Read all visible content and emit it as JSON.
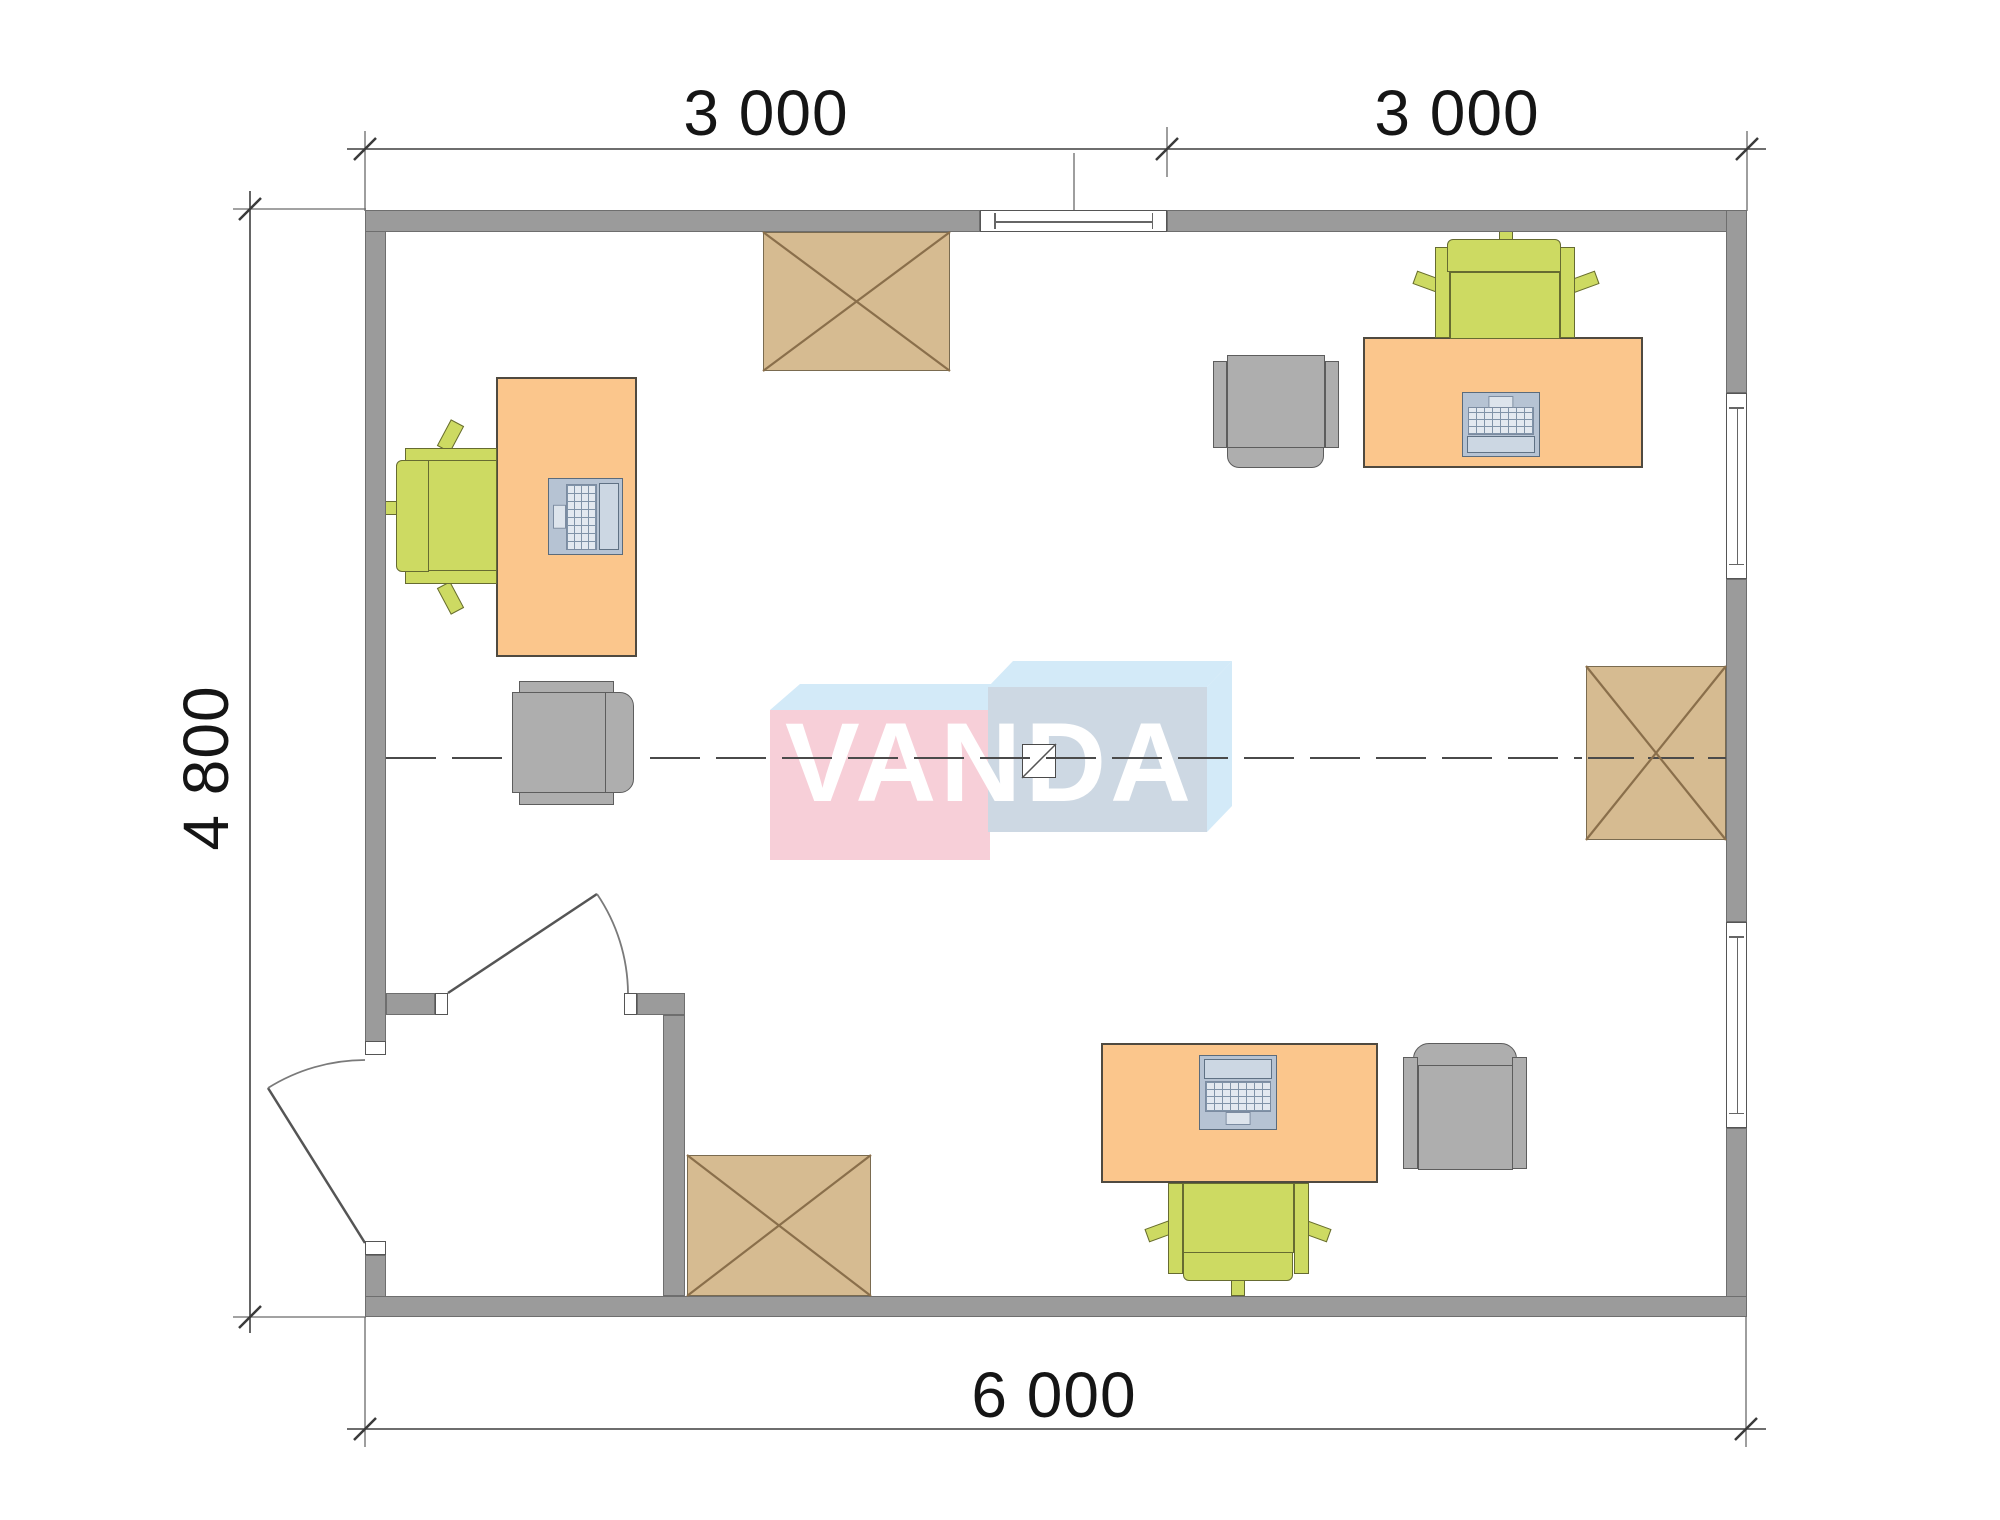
{
  "dimension_labels": {
    "top_left_span": "3 000",
    "top_right_span": "3 000",
    "left_span": "4 800",
    "bottom_span": "6 000"
  },
  "watermark": {
    "brand": "VANDA"
  },
  "plan": {
    "units": "mm",
    "room_width": "6 000",
    "room_depth": "4 800",
    "module_spans": [
      "3 000",
      "3 000"
    ]
  },
  "symbols": {
    "desks": 3,
    "laptops": 3,
    "green-office-chairs": 3,
    "gray-chairs": 3,
    "crossed-tables": 3,
    "windows": 3,
    "doors": 2
  },
  "colors": {
    "wall": "#9b9b9b",
    "wall_edge": "#6e6e6e",
    "desk": "#fbc68c",
    "desk_edge": "#4f4a40",
    "green": "#cdda62",
    "green_edge": "#666b31",
    "gray": "#aeaeae",
    "gray_edge": "#5d5d5d",
    "tan": "#d6bb91",
    "tan_edge": "#7a6b50",
    "tan_x": "#8a6f4b",
    "pink": "#f7cfd8",
    "light_blue": "#d3eaf8",
    "blue_face": "#cdd8e3",
    "dim_text": "#151515"
  }
}
